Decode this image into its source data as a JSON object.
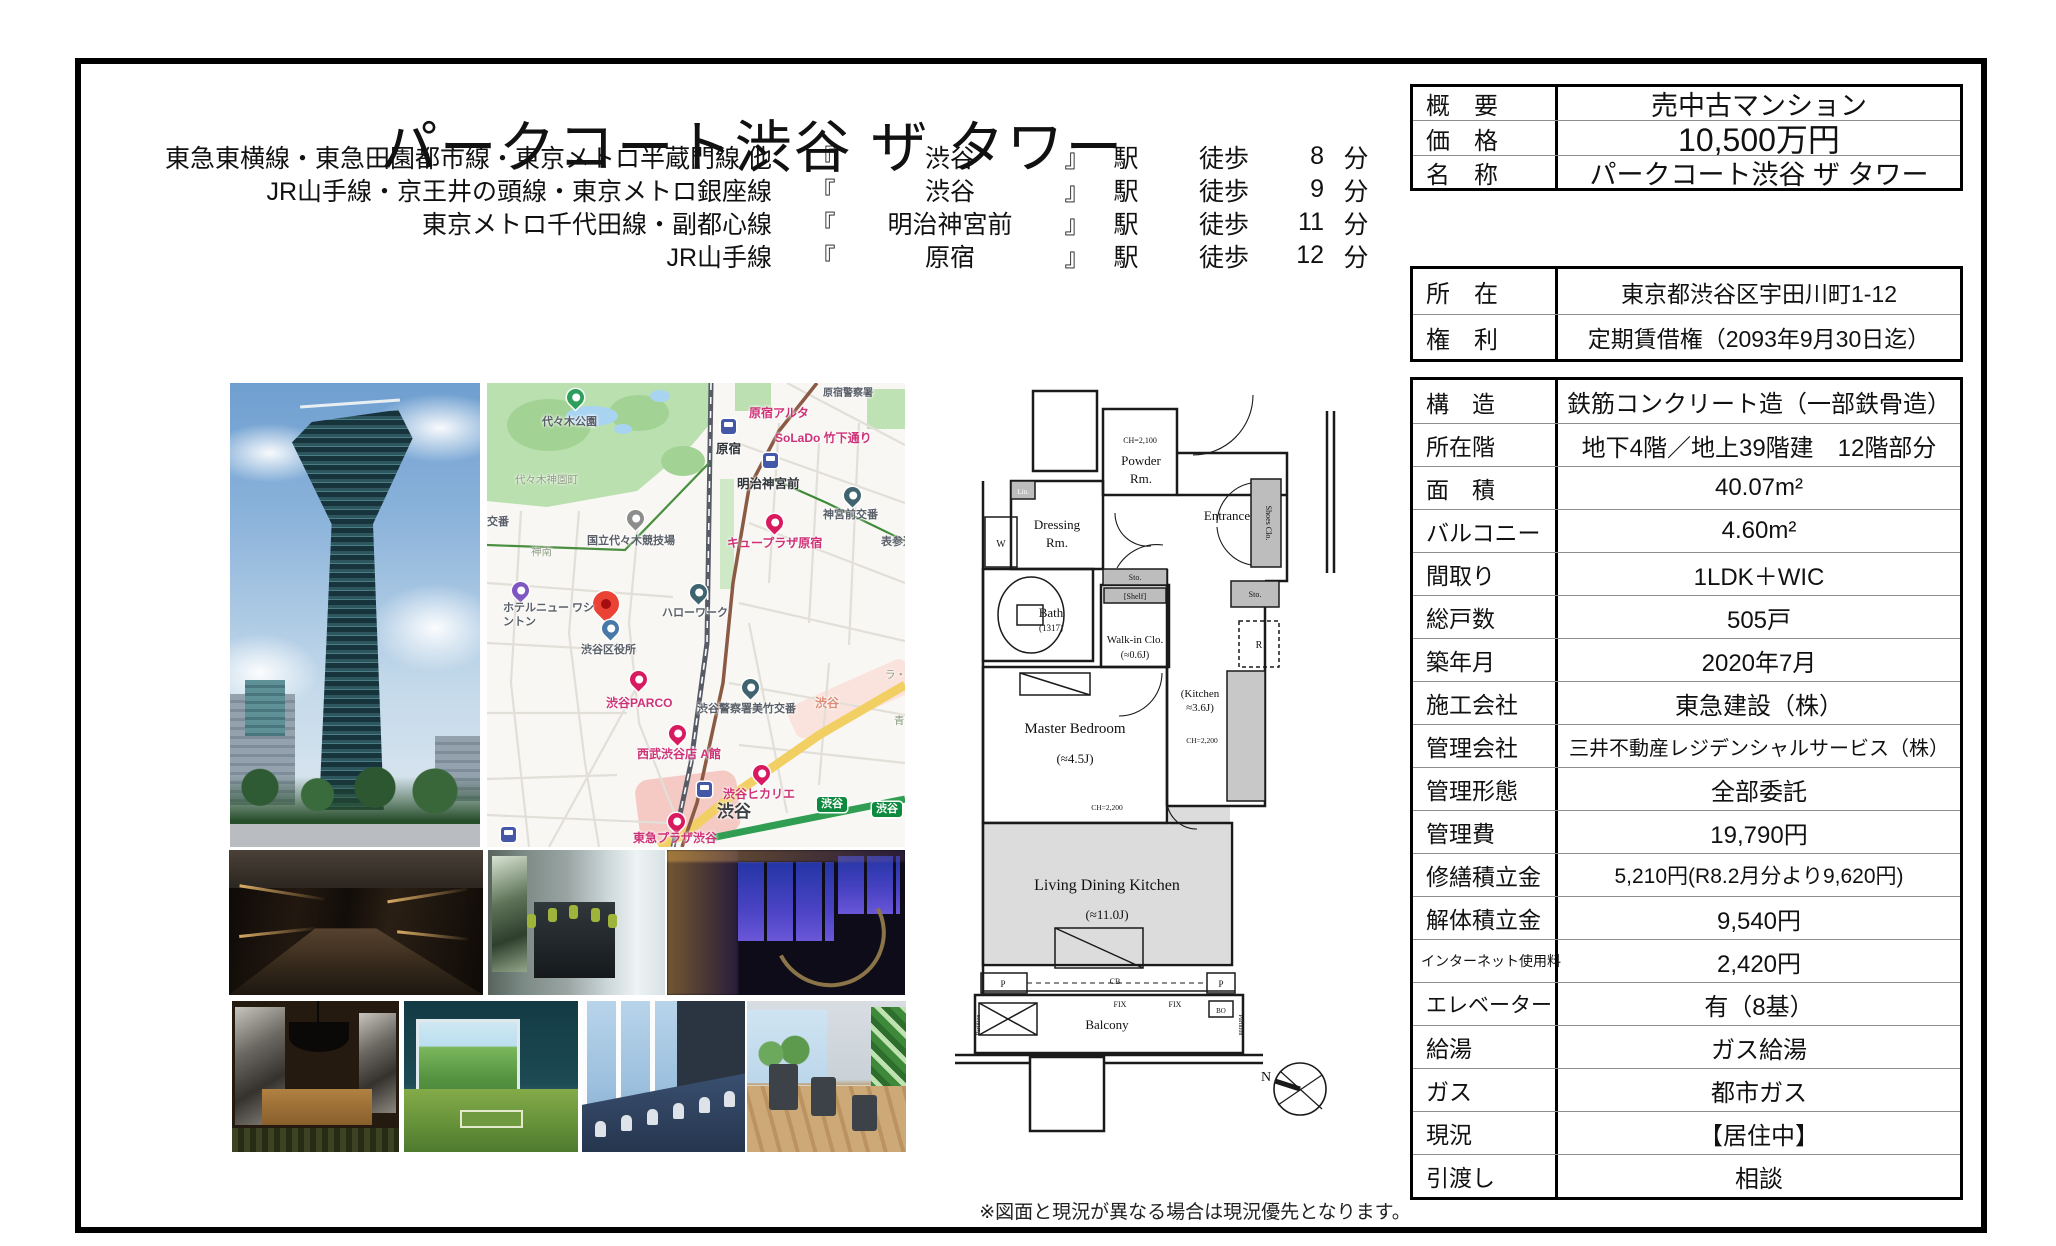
{
  "title": "パークコート渋谷 ザ タワー",
  "access": {
    "tokens": {
      "open": "『",
      "close": "』",
      "station_suffix": "駅",
      "walk": "徒歩",
      "minute": "分"
    },
    "rows": [
      {
        "route": "東急東横線・東急田園都市線・東京メトロ半蔵門線 他",
        "station": "渋谷",
        "minutes": "8"
      },
      {
        "route": "JR山手線・京王井の頭線・東京メトロ銀座線",
        "station": "渋谷",
        "minutes": "9"
      },
      {
        "route": "東京メトロ千代田線・副都心線",
        "station": "明治神宮前",
        "minutes": "11"
      },
      {
        "route": "JR山手線",
        "station": "原宿",
        "minutes": "12"
      }
    ]
  },
  "summary_table": {
    "rows": [
      {
        "label": "概　要",
        "value": "売中古マンション"
      },
      {
        "label": "価　格",
        "value": "10,500万円"
      },
      {
        "label": "名　称",
        "value": "パークコート渋谷 ザ タワー"
      }
    ]
  },
  "location_table": {
    "rows": [
      {
        "label": "所　在",
        "value": "東京都渋谷区宇田川町1-12"
      },
      {
        "label": "権　利",
        "value": "定期賃借権（2093年9月30日迄）"
      }
    ]
  },
  "details_table": {
    "rows": [
      {
        "label": "構　造",
        "value": "鉄筋コンクリート造（一部鉄骨造）"
      },
      {
        "label": "所在階",
        "value": "地下4階／地上39階建　12階部分"
      },
      {
        "label": "面　積",
        "value": "40.07m²"
      },
      {
        "label": "バルコニー",
        "value": "4.60m²"
      },
      {
        "label": "間取り",
        "value": "1LDK＋WIC"
      },
      {
        "label": "総戸数",
        "value": "505戸"
      },
      {
        "label": "築年月",
        "value": "2020年7月"
      },
      {
        "label": "施工会社",
        "value": "東急建設（株）"
      },
      {
        "label": "管理会社",
        "value": "三井不動産レジデンシャルサービス（株）"
      },
      {
        "label": "管理形態",
        "value": "全部委託"
      },
      {
        "label": "管理費",
        "value": "19,790円"
      },
      {
        "label": "修繕積立金",
        "value": "5,210円(R8.2月分より9,620円)"
      },
      {
        "label": "解体積立金",
        "value": "9,540円"
      },
      {
        "label": "インターネット使用料",
        "value": "2,420円"
      },
      {
        "label": "エレベーター",
        "value": "有（8基）"
      },
      {
        "label": "給湯",
        "value": "ガス給湯"
      },
      {
        "label": "ガス",
        "value": "都市ガス"
      },
      {
        "label": "現況",
        "value": "【居住中】"
      },
      {
        "label": "引渡し",
        "value": "相談"
      }
    ]
  },
  "map": {
    "labels": [
      {
        "text": "代々木公園"
      },
      {
        "text": "原宿警察署"
      },
      {
        "text": "原宿アルタ"
      },
      {
        "text": "SoLaDo 竹下通り"
      },
      {
        "text": "原宿"
      },
      {
        "text": "明治神宮前"
      },
      {
        "text": "神宮前交番"
      },
      {
        "text": "代々木神園町"
      },
      {
        "text": "国立代々木競技場"
      },
      {
        "text": "神南"
      },
      {
        "text": "キュープラザ原宿"
      },
      {
        "text": "表参道"
      },
      {
        "text": "交番"
      },
      {
        "text": "ホテルニュー ワシントン"
      },
      {
        "text": "ハローワーク"
      },
      {
        "text": "渋谷区役所"
      },
      {
        "text": "渋谷PARCO"
      },
      {
        "text": "渋谷警察署美竹交番"
      },
      {
        "text": "渋谷"
      },
      {
        "text": "西武渋谷店 A館"
      },
      {
        "text": "渋谷ヒカリエ"
      },
      {
        "text": "渋谷"
      },
      {
        "text": "東急プラザ渋谷"
      },
      {
        "text": "渋谷"
      },
      {
        "text": "渋谷"
      },
      {
        "text": "青"
      },
      {
        "text": "ラ・"
      }
    ],
    "icons": {
      "red-pin": "property-location-marker",
      "pink-pin": "shopping-marker",
      "blue-pin": "government-building-marker",
      "teal-pin": "police-public-office-marker",
      "purple-pin": "hotel-marker",
      "gray-pin": "stadium-marker",
      "green-pin": "park-marker",
      "station-icon": "train-station",
      "compass": "north-arrow"
    }
  },
  "floorplan": {
    "powder_l1": "Powder",
    "powder_l2": "Rm.",
    "ch_powder": "CH=2,100",
    "dressing_l1": "Dressing",
    "dressing_l2": "Rm.",
    "entrance": "Entrance",
    "shoes": "Shoes Clo.",
    "lin": "Lin.",
    "w": "W",
    "bath": "Bath",
    "bath_size": "(1317)",
    "sto1": "Sto.",
    "shelf": "[Shelf]",
    "walkin": "Walk-in Clo.",
    "walkin_size": "(≈0.6J)",
    "sto2": "Sto.",
    "fridge": "R",
    "master": "Master Bedroom",
    "master_size": "(≈4.5J)",
    "kitchen_l1": "(Kitchen",
    "kitchen_l2": "≈3.6J)",
    "ch1": "CH=2,200",
    "ch2": "CH=2,200",
    "ldk": "Living Dining Kitchen",
    "ldk_size": "(≈11.0J)",
    "balcony": "Balcony",
    "fix1": "FIX",
    "fix2": "FIX",
    "bo": "BO",
    "p1": "P",
    "p2": "P",
    "cb": "CB",
    "partition1": "Partition",
    "partition2": "Partition",
    "north": "N"
  },
  "footnote": "※図面と現況が異なる場合は現況優先となります。"
}
